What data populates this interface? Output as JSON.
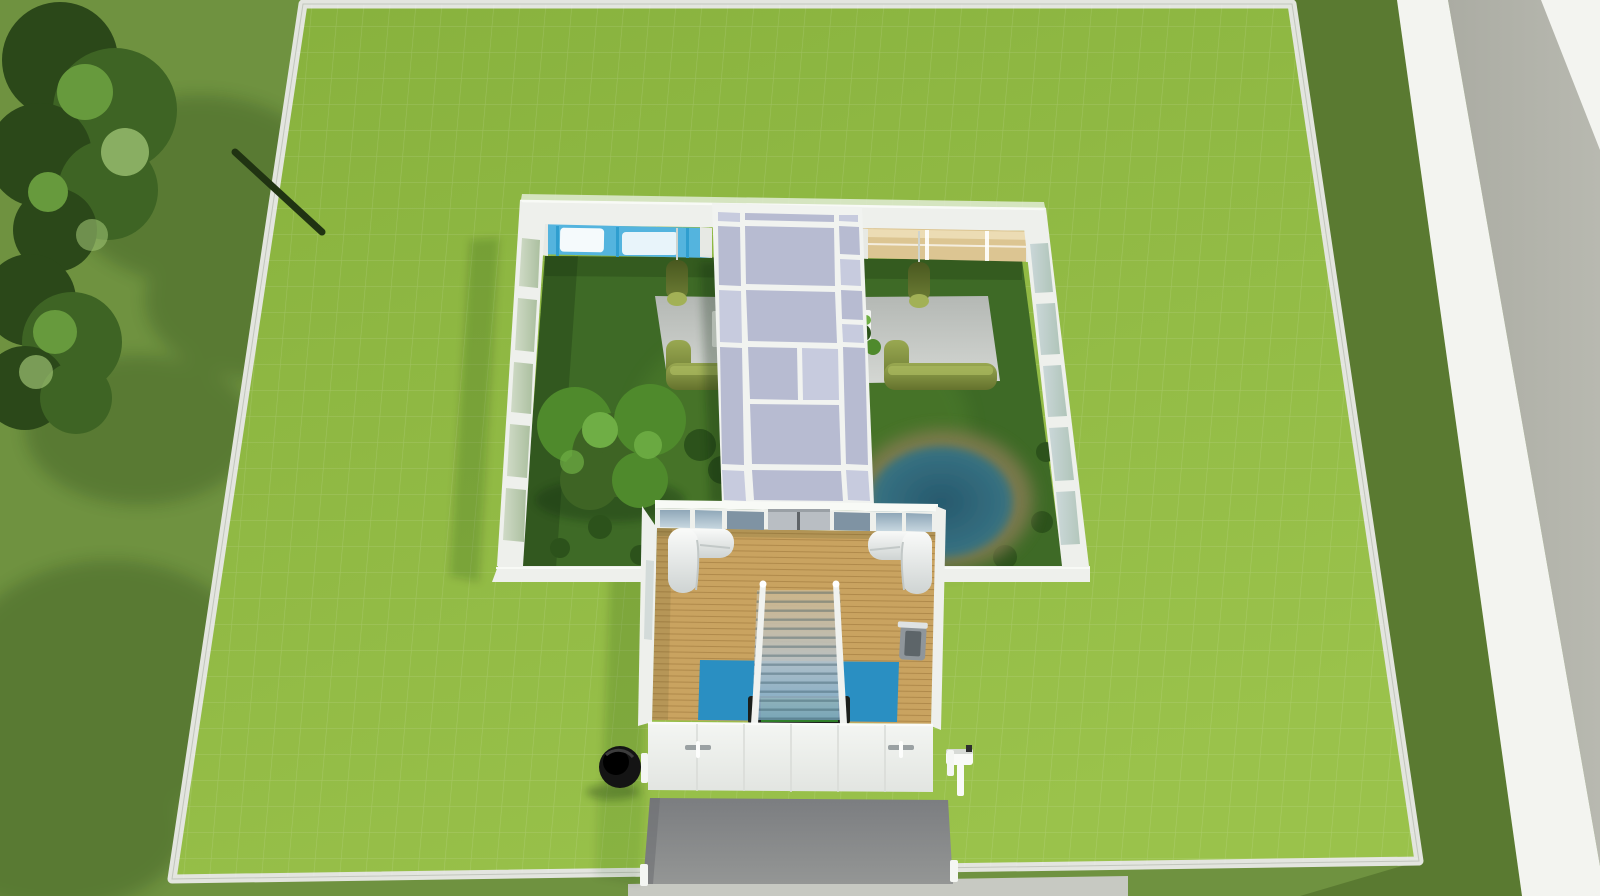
{
  "meta": {
    "view_label": "Aerial build-mode view of a residential lot",
    "ui_text_visible": "none"
  },
  "colors": {
    "outsideGrass": "#6f9240",
    "outsideGrassDark": "#5a7a31",
    "lotGrass": "#8fb944",
    "fence": "#e3e5df",
    "road": "#b2b3aa",
    "sidewalk": "#f3f4f0",
    "sidewalkStrip": "#c7c9c2",
    "treeDark": "#2b4819",
    "treeMid": "#3e6424",
    "treeLight": "#679a3d",
    "treeHighlight": "#9cc172",
    "branch": "#203312",
    "courtyardGrass": "#3e6a26",
    "bush": "#2c521b",
    "courtTree": "#4f8a2c",
    "courtTreeLight": "#6fae45",
    "pondWater": "#2f6478",
    "pondMud": "#857c52",
    "patio": "#bfc2be",
    "tableWhite": "#f3f5f2",
    "hedgeFront": "#68762f",
    "topiary": "#5c6c2d",
    "topiaryCap": "#a2b156",
    "wallWhite": "#eef0ec",
    "wallFace": "#e7e9e4",
    "roofEdge": "#f8faf6",
    "corridorFrame": "#f1f3f0",
    "corridorGlass": "#b7bbd1",
    "corridorGlassLight": "#c7cbde",
    "poolRoomBlue": "#54b4de",
    "poolRoomWhite": "#f5fafc",
    "poolMullion": "#2f9ecf",
    "woodView": "#dcc592",
    "woodViewLight": "#ecdcb4",
    "gymWood": "#c9a360",
    "doorGray": "#b9bec3",
    "doorSeam": "#5f6468",
    "sofaWhite": "#f7f8f7",
    "railWhite": "#f0f2ef",
    "rugBlue": "#2a8fc2",
    "feltGreen": "#3f9e33",
    "tableEnd": "#1b1f1b",
    "treadmill": "#8f969b",
    "treadmillBelt": "#5d6569",
    "frontWall": "#f1f3f0",
    "handle": "#9aa1a3",
    "handlePull": "#fcfdfc",
    "driveway": "#87888b",
    "grill": "#141414",
    "mailbox": "#f9faf8",
    "postWhite": "#f4f6f3"
  },
  "scene": {
    "objects": {
      "lot": {
        "label": "Residential lot (fenced grass)"
      },
      "road": {
        "label": "Street"
      },
      "sidewalk": {
        "label": "Sidewalk"
      },
      "streetTrees": {
        "label": "Trees outside lot"
      },
      "conservatory": {
        "label": "Glass conservatory building with courtyard"
      },
      "corridor": {
        "label": "Glass-roofed corridor"
      },
      "courtyard": {
        "label": "Walled courtyard garden"
      },
      "courtyardTrees": {
        "label": "Courtyard trees and shrubs"
      },
      "pond": {
        "label": "Courtyard pond"
      },
      "patioLeft": {
        "label": "Left courtyard patio"
      },
      "patioRight": {
        "label": "Right courtyard patio"
      },
      "hedgeSofaLeft": {
        "label": "Hedge sofa (left patio)"
      },
      "hedgeSofaRight": {
        "label": "Hedge sofa (right patio)"
      },
      "topiaryLeft": {
        "label": "Hanging topiary (left)"
      },
      "topiaryRight": {
        "label": "Hanging topiary (right)"
      },
      "poolRoom": {
        "label": "Indoor pool room (north wing)"
      },
      "woodRoom": {
        "label": "Wood-floored room (north wing)"
      },
      "gym": {
        "label": "South building - wood floor lounge"
      },
      "sofaLeft": {
        "label": "White sectional sofa (left)"
      },
      "sofaRight": {
        "label": "White sectional sofa (right)"
      },
      "stairs": {
        "label": "Staircase"
      },
      "rug": {
        "label": "Blue rug"
      },
      "poolTable": {
        "label": "Pool table"
      },
      "treadmill": {
        "label": "Treadmill"
      },
      "slidingDoors": {
        "label": "Sliding doors to courtyard"
      },
      "frontDoors": {
        "label": "Front wall doors"
      },
      "driveway": {
        "label": "Concrete driveway"
      },
      "grill": {
        "label": "Barbecue grill"
      },
      "mailboxObj": {
        "label": "Mailbox"
      }
    }
  }
}
